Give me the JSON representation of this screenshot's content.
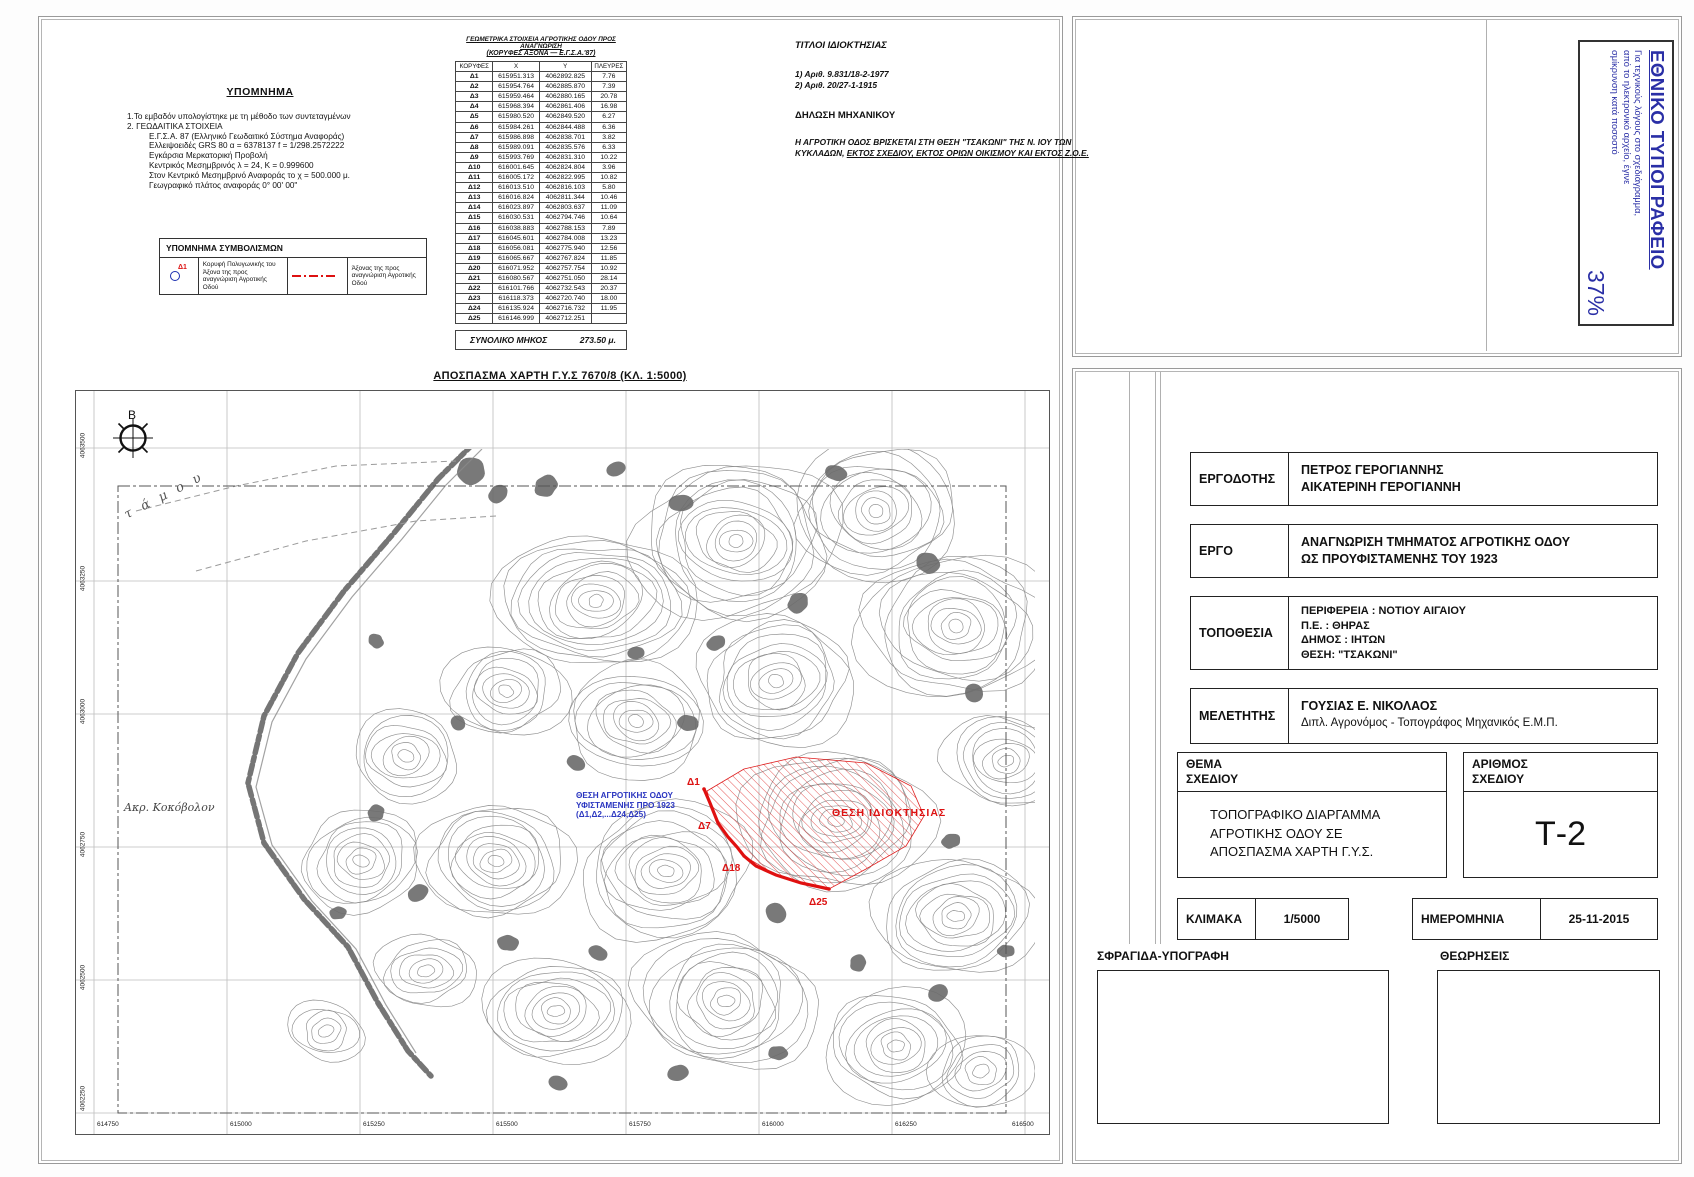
{
  "legend": {
    "title": "ΥΠΟΜΝΗΜΑ",
    "line1": "1.Το εμβαδόν υπολογίστηκε με τη μέθοδο των συντεταγμένων",
    "line2": "2. ΓΕΩΔΑΙΤΙΚΑ ΣΤΟΙΧΕΙΑ",
    "details": [
      "Ε.Γ.Σ.Α. 87 (Ελληνικό Γεωδαιτικό Σύστημα Αναφοράς)",
      "Ελλειψοειδές GRS 80  α = 6378137     f = 1/298.2572222",
      "Εγκάρσια Μερκατορική Προβολή",
      "Κεντρικός Μεσημβρινός λ = 24, Κ = 0.999600",
      "Στον Κεντρικό Μεσημβρινό Αναφοράς το χ = 500.000 μ.",
      "Γεωγραφικό πλάτος αναφοράς 0° 00' 00\""
    ]
  },
  "symbols": {
    "title": "ΥΠΟΜΝΗΜΑ ΣΥΜΒΟΛΙΣΜΩΝ",
    "point_label": "Δ1",
    "point_desc": "Κορυφή Πολυγωνικής του Άξονα της προς αναγνώριση Αγροτικής Οδού",
    "axis_desc": "Άξονας της προς αναγνώριση Αγροτικής Οδού"
  },
  "coords_table": {
    "title": "ΓΕΩΜΕΤΡΙΚΑ ΣΤΟΙΧΕΙΑ ΑΓΡΟΤΙΚΗΣ ΟΔΟΥ ΠΡΟΣ ΑΝΑΓΝΩΡΙΣΗ",
    "subtitle": "(ΚΟΡΥΦΕΣ ΑΞΟΝΑ — Ε.Γ.Σ.Α.'87)",
    "headers": [
      "ΚΟΡΥΦΕΣ",
      "Χ",
      "Υ",
      "ΠΛΕΥΡΕΣ"
    ],
    "rows": [
      [
        "Δ1",
        "615951.313",
        "4062892.825",
        "7.76"
      ],
      [
        "Δ2",
        "615954.764",
        "4062885.870",
        "7.39"
      ],
      [
        "Δ3",
        "615959.464",
        "4062880.165",
        "20.78"
      ],
      [
        "Δ4",
        "615968.394",
        "4062861.406",
        "16.98"
      ],
      [
        "Δ5",
        "615980.520",
        "4062849.520",
        "6.27"
      ],
      [
        "Δ6",
        "615984.261",
        "4062844.488",
        "6.36"
      ],
      [
        "Δ7",
        "615986.898",
        "4062838.701",
        "3.82"
      ],
      [
        "Δ8",
        "615989.091",
        "4062835.576",
        "6.33"
      ],
      [
        "Δ9",
        "615993.769",
        "4062831.310",
        "10.22"
      ],
      [
        "Δ10",
        "616001.645",
        "4062824.804",
        "3.96"
      ],
      [
        "Δ11",
        "616005.172",
        "4062822.995",
        "10.82"
      ],
      [
        "Δ12",
        "616013.510",
        "4062816.103",
        "5.80"
      ],
      [
        "Δ13",
        "616016.824",
        "4062811.344",
        "10.46"
      ],
      [
        "Δ14",
        "616023.897",
        "4062803.637",
        "11.09"
      ],
      [
        "Δ15",
        "616030.531",
        "4062794.746",
        "10.64"
      ],
      [
        "Δ16",
        "616038.883",
        "4062788.153",
        "7.89"
      ],
      [
        "Δ17",
        "616045.601",
        "4062784.008",
        "13.23"
      ],
      [
        "Δ18",
        "616056.081",
        "4062775.940",
        "12.56"
      ],
      [
        "Δ19",
        "616065.667",
        "4062767.824",
        "11.85"
      ],
      [
        "Δ20",
        "616071.952",
        "4062757.754",
        "10.92"
      ],
      [
        "Δ21",
        "616080.567",
        "4062751.050",
        "28.14"
      ],
      [
        "Δ22",
        "616101.766",
        "4062732.543",
        "20.37"
      ],
      [
        "Δ23",
        "616118.373",
        "4062720.740",
        "18.00"
      ],
      [
        "Δ24",
        "616135.924",
        "4062716.732",
        "11.95"
      ],
      [
        "Δ25",
        "616146.999",
        "4062712.251",
        ""
      ]
    ],
    "total_label": "ΣΥΝΟΛΙΚΟ ΜΗΚΟΣ",
    "total_value": "273.50 μ."
  },
  "titles_block": {
    "title": "ΤΙΤΛΟΙ ΙΔΙΟΚΤΗΣΙΑΣ",
    "items": [
      "1) Αριθ. 9.831/18-2-1977",
      "2) Αριθ. 20/27-1-1915"
    ]
  },
  "declaration": {
    "title": "ΔΗΛΩΣΗ ΜΗΧΑΝΙΚΟΥ",
    "line1": "Η ΑΓΡΟΤΙΚΗ ΟΔΟΣ ΒΡΙΣΚΕΤΑΙ ΣΤΗ ΘΕΣΗ \"ΤΣΑΚΩΝΙ\" ΤΗΣ Ν. ΙΟΥ ΤΩΝ",
    "line2_plain": "ΚΥΚΛΑΔΩΝ, ",
    "line2_underline": "ΕΚΤΟΣ ΣΧΕΔΙΟΥ, ΕΚΤΟΣ ΟΡΙΩΝ ΟΙΚΙΣΜΟΥ ΚΑΙ ΕΚΤΟΣ Ζ.Ο.Ε."
  },
  "map": {
    "title": "ΑΠΟΣΠΑΣΜΑ ΧΑΡΤΗ Γ.Υ.Σ 7670/8 (ΚΛ. 1:5000)",
    "north_label": "B",
    "x_ticks": [
      "614750",
      "615000",
      "615250",
      "615500",
      "615750",
      "616000",
      "616250",
      "616500"
    ],
    "y_ticks": [
      "4063500",
      "4063250",
      "4063000",
      "4062750",
      "4062500",
      "4062250"
    ],
    "blue_note": [
      "ΘΕΣΗ ΑΓΡΟΤΙΚΗΣ ΟΔΟΥ",
      "ΥΦΙΣΤΑΜΕΝΗΣ ΠΡΟ 1923",
      "(Δ1,Δ2,...Δ24,Δ25)"
    ],
    "red_note": "ΘΕΣΗ ΙΔΙΟΚΤΗΣΙΑΣ",
    "point_labels": [
      "Δ1",
      "Δ7",
      "Δ18",
      "Δ25"
    ],
    "cape_label": "Ακρ. Κοκόβολον",
    "stream_label": "τάμου",
    "accent_red": "#dd1111",
    "accent_blue": "#2a35c0"
  },
  "stamp": {
    "title": "ΕΘΝΙΚΟ ΤΥΠΟΓΡΑΦΕΙΟ",
    "line1": "Για τεχνικούς λόγους στο σχεδιάγραμμα,",
    "line2": "από το ηλεκτρονικό αρχείο, έγινε",
    "line3": "σμίκρυνση κατά ποσοστό",
    "percent": "37%",
    "color": "#2a2fa6"
  },
  "titleblock": {
    "ergodotis": {
      "label": "ΕΡΓΟΔΟΤΗΣ",
      "line1": "ΠΕΤΡΟΣ ΓΕΡΟΓΙΑΝΝΗΣ",
      "line2": "ΑΙΚΑΤΕΡΙΝΗ ΓΕΡΟΓΙΑΝΝΗ"
    },
    "ergo": {
      "label": "ΕΡΓΟ",
      "line1": "ΑΝΑΓΝΩΡΙΣΗ ΤΜΗΜΑΤΟΣ ΑΓΡΟΤΙΚΗΣ ΟΔΟΥ",
      "line2": "ΩΣ ΠΡΟΥΦΙΣΤΑΜΕΝΗΣ ΤΟΥ 1923"
    },
    "topothesia": {
      "label": "ΤΟΠΟΘΕΣΙΑ",
      "line1": "ΠΕΡΙΦΕΡΕΙΑ : ΝΟΤΙΟΥ ΑΙΓΑΙΟΥ",
      "line2": "Π.Ε. : ΘΗΡΑΣ",
      "line3": "ΔΗΜΟΣ : ΙΗΤΩΝ",
      "line4": "ΘΕΣΗ:  \"ΤΣΑΚΩΝΙ\""
    },
    "meletitis": {
      "label": "ΜΕΛΕΤΗΤΗΣ",
      "line1": "ΓΟΥΣΙΑΣ Ε. ΝΙΚΟΛΑΟΣ",
      "line2": "Διπλ. Αγρονόμος - Τοπογράφος Μηχανικός Ε.Μ.Π."
    },
    "thema": {
      "label1": "ΘΕΜΑ",
      "label2": "ΣΧΕΔΙΟΥ",
      "line1": "ΤΟΠΟΓΡΑΦΙΚΟ ΔΙΑΡΓΑΜΜΑ",
      "line2": "ΑΓΡΟΤΙΚΗΣ ΟΔΟΥ ΣΕ",
      "line3": "ΑΠΟΣΠΑΣΜΑ ΧΑΡΤΗ Γ.Υ.Σ."
    },
    "arithmos": {
      "label1": "ΑΡΙΘΜΟΣ",
      "label2": "ΣΧΕΔΙΟΥ",
      "value": "Τ-2"
    },
    "klimaka": {
      "label": "ΚΛΙΜΑΚΑ",
      "value": "1/5000"
    },
    "imerominia": {
      "label": "ΗΜΕΡΟΜΗΝΙΑ",
      "value": "25-11-2015"
    },
    "sfragida": {
      "label": "ΣΦΡΑΓΙΔΑ-ΥΠΟΓΡΑΦΗ"
    },
    "theoriseis": {
      "label": "ΘΕΩΡΗΣΕΙΣ"
    }
  }
}
